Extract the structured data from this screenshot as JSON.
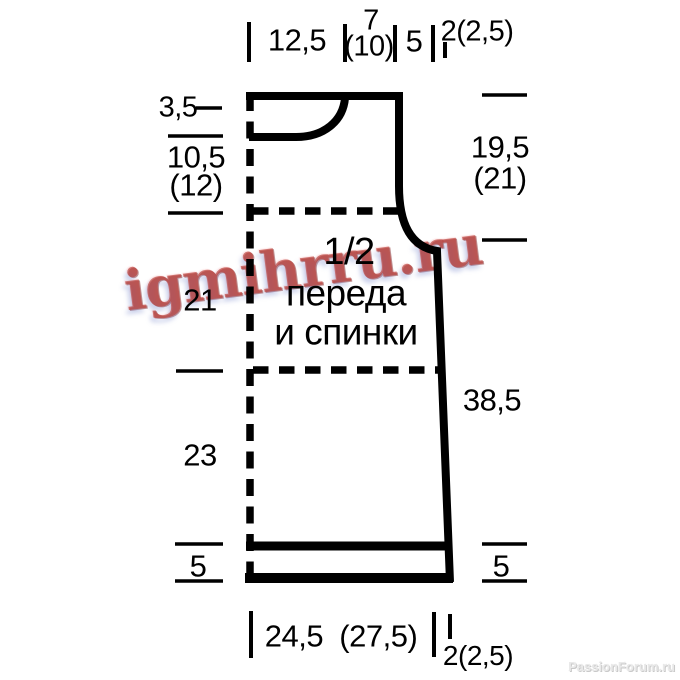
{
  "watermark": "igmihrru.ru",
  "credit": "PassionForum.ru",
  "center_label": [
    "1/2",
    "переда",
    "и спинки"
  ],
  "measurements": {
    "top": [
      "12,5",
      "7",
      "(10)",
      "5",
      "2(2,5)"
    ],
    "left": [
      "3,5",
      "10,5",
      "(12)",
      "21",
      "23",
      "5"
    ],
    "right": [
      "19,5",
      "(21)",
      "38,5",
      "5"
    ],
    "bottom": [
      "24,5  (27,5)",
      "2(2,5)"
    ]
  },
  "colors": {
    "line": "#000000",
    "watermark_red": "#ba3e38",
    "credit_gray": "#e9e9e9"
  }
}
